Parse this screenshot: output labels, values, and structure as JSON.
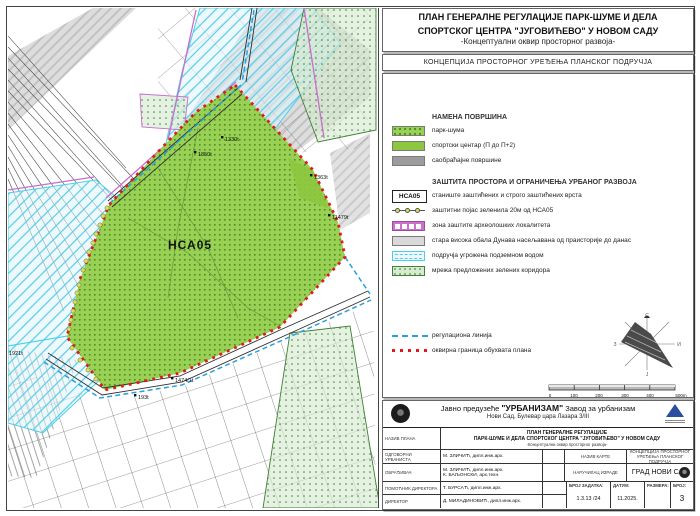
{
  "colors": {
    "park_green": "#98d153",
    "park_dot": "#4f8c2a",
    "sports_green": "#8dc63f",
    "roads_gray": "#9c9c9c",
    "corridor_green": "#d8ebd1",
    "corridor_line": "#3f7f36",
    "groundwater_cyan": "#49cfe8",
    "archaeology_magenta": "#cc70cc",
    "old_bank_gray": "#d9d9d9",
    "regulation_blue": "#2a9fe0",
    "boundary_red": "#e0191e",
    "belt_yellow": "#dde24a"
  },
  "header": {
    "title_line1": "ПЛАН ГЕНЕРАЛНЕ РЕГУЛАЦИЈЕ ПАРК-ШУМЕ И ДЕЛА",
    "title_line2": "СПОРТСКОГ ЦЕНТРА \"ЈУГОВИЋЕВО\" У НОВОМ САДУ",
    "title_line3": "-Концептуални оквир просторног развоја-",
    "map_title": "КОНЦЕПЦИЈА ПРОСТОРНОГ УРЕЂЕЊА ПЛАНСКОГ ПОДРУЧЈА"
  },
  "legend": {
    "land_use_heading": "НАМЕНА ПОВРШИНА",
    "land_use": [
      {
        "label": "парк-шума"
      },
      {
        "label": "спортски центар (П до П+2)"
      },
      {
        "label": "саобраћајне површине"
      }
    ],
    "protection_heading": "ЗАШТИТА ПРОСТОРА И ОГРАНИЧЕЊА УРБАНОГ РАЗВОЈА",
    "nsa_badge": "НСА05",
    "protection": [
      {
        "label": "станиште заштићених и строго заштићених врста"
      },
      {
        "label": "заштитни појас зеленила 20м од НСА05"
      },
      {
        "label": "зона заштите археолошких локалитета"
      },
      {
        "label": "стара висока обала Дунава насељавана од праисторије до данас"
      },
      {
        "label": "подручја угрожена подземном водом"
      },
      {
        "label": "мрежа предложених зелених коридора"
      }
    ],
    "lines": [
      {
        "label": "регулациона линија"
      },
      {
        "label": "оквирна граница обухвата плана"
      }
    ]
  },
  "map": {
    "area_label": "НСА05",
    "parcel_labels": [
      "1330t",
      "1850t",
      "1363t",
      "11479t",
      "1921t",
      "1474/1t",
      "193t"
    ]
  },
  "compass": {
    "n": "С",
    "e": "И",
    "s": "Ј",
    "w": "З"
  },
  "scalebar": {
    "ticks": [
      "0",
      "100",
      "200",
      "300",
      "400"
    ],
    "end": "500m"
  },
  "titleblock": {
    "company_pre": "Јавно предузеће",
    "company_name": "\"УРБАНИЗАМ\"",
    "company_post": "Завод за урбанизам",
    "company_address": "Нови Сад, Булевар цара Лазара 3/III",
    "plan_label": "НАЗИВ ПЛАНА",
    "plan_line1": "ПЛАН ГЕНЕРАЛНЕ РЕГУЛАЦИЈЕ",
    "plan_line2": "ПАРК-ШУМЕ И ДЕЛА СПОРТСКОГ ЦЕНТРА \"ЈУГОВИЋЕВО\" У НОВОМ САДУ",
    "plan_line3": "-Концептуални оквир просторног развоја-",
    "rows": [
      {
        "label": "ОДГОВОРНИ УРБАНИСТА",
        "value": "М. ЗЛИЧИЋ, дипл.инж.арх."
      },
      {
        "label": "ОБРАЂИВАЧ",
        "value": "М. ЗЛИЧИЋ, дипл.инж.арх.",
        "value2": "К. БАЉОНСКИ, арх.техн."
      },
      {
        "label": "ПОМОЋНИК ДИРЕКТОРА",
        "value": "Т. БУРСАЋ, дипл.инж.арх."
      },
      {
        "label": "ДИРЕКТОР",
        "value": "Д. МИЛАДИНОВИЋ, дипл.инж.арх."
      }
    ],
    "map_name_label": "НАЗИВ КАРТЕ",
    "map_name_value": "КОНЦЕПЦИЈА ПРОСТОРНОГ УРЕЂЕЊА ПЛАНСКОГ ПОДРУЧЈА",
    "client_label": "НАРУЧИЛАЦ ИЗРАДЕ",
    "client_value": "ГРАД НОВИ САД",
    "task_label": "БРОЈ ЗАДАТКА:",
    "task_value": "1.3.13 /24",
    "date_label": "ДАТУМ:",
    "date_value": "11.2025.",
    "scale_label": "РАЗМЕРА:",
    "scale_value": "",
    "number_label": "БРОЈ:",
    "number_value": "3"
  }
}
